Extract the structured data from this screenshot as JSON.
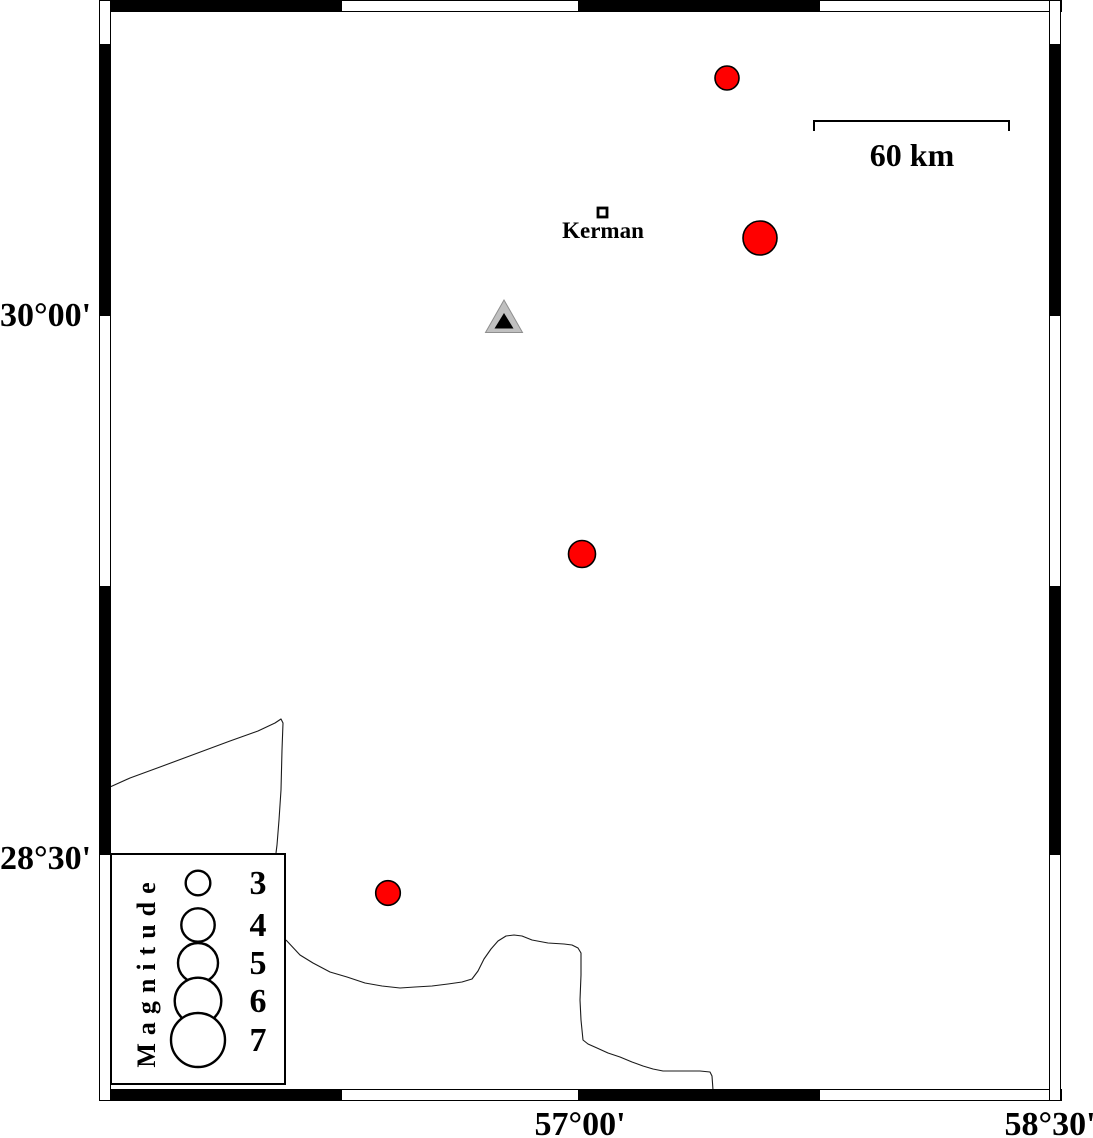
{
  "map": {
    "axis_labels": {
      "left": [
        {
          "text": "30°00'",
          "y_px": 315,
          "latitude": "30°00'"
        },
        {
          "text": "28°30'",
          "y_px": 858,
          "latitude": "28°30'"
        }
      ],
      "bottom": [
        {
          "text": "57°00'",
          "x_px": 580,
          "longitude": "57°00'"
        },
        {
          "text": "58°30'",
          "x_px": 1050,
          "longitude": "58°30'"
        }
      ]
    },
    "scale_bar": {
      "label": "60 km",
      "x1": 814,
      "x2": 1009,
      "y": 121,
      "tick_drop": 10,
      "length_km": 60
    },
    "city": {
      "name": "Kerman",
      "marker": {
        "shape": "open-square",
        "x": 598,
        "y": 208,
        "size": 9
      }
    },
    "station": {
      "symbol": "triangle",
      "outer_points": [
        [
          504,
          300
        ],
        [
          485.5,
          332.5
        ],
        [
          522.5,
          332.5
        ]
      ],
      "inner_points": [
        [
          504,
          313
        ],
        [
          494.5,
          328.5
        ],
        [
          513.5,
          328.5
        ]
      ]
    },
    "earthquakes": [
      {
        "x": 727,
        "y": 78,
        "r_px": 12.0,
        "magnitude_approx": 3.0,
        "lon_approx": 57.45,
        "lat_approx": 30.66
      },
      {
        "x": 760,
        "y": 238,
        "r_px": 17.0,
        "magnitude_approx": 4.1,
        "lon_approx": 57.56,
        "lat_approx": 30.21
      },
      {
        "x": 582,
        "y": 554,
        "r_px": 13.5,
        "magnitude_approx": 3.3,
        "lon_approx": 57.0,
        "lat_approx": 29.34
      },
      {
        "x": 388,
        "y": 893,
        "r_px": 12.3,
        "magnitude_approx": 3.0,
        "lon_approx": 56.39,
        "lat_approx": 28.4
      }
    ],
    "coastlines": [
      [
        [
          110,
          787
        ],
        [
          130,
          778
        ],
        [
          160,
          767
        ],
        [
          195,
          754
        ],
        [
          230,
          741
        ],
        [
          258,
          731
        ],
        [
          275,
          723
        ],
        [
          281,
          719
        ],
        [
          283,
          723
        ],
        [
          282,
          750
        ],
        [
          281,
          790
        ],
        [
          279,
          820
        ],
        [
          277,
          845
        ],
        [
          276,
          853
        ]
      ],
      [
        [
          286,
          940
        ],
        [
          300,
          955
        ],
        [
          313,
          963
        ],
        [
          330,
          972
        ],
        [
          347,
          977
        ],
        [
          365,
          983
        ],
        [
          382,
          986
        ],
        [
          400,
          988
        ],
        [
          415,
          987
        ],
        [
          432,
          986
        ],
        [
          448,
          984
        ],
        [
          462,
          982
        ],
        [
          472,
          979
        ],
        [
          478,
          971
        ],
        [
          484,
          959
        ],
        [
          491,
          949
        ],
        [
          498,
          941
        ],
        [
          506,
          936
        ],
        [
          514,
          935
        ],
        [
          522,
          936
        ],
        [
          532,
          940
        ],
        [
          548,
          943
        ],
        [
          564,
          944
        ],
        [
          572,
          945
        ],
        [
          578,
          948
        ],
        [
          581,
          953
        ],
        [
          581,
          975
        ],
        [
          580,
          1000
        ],
        [
          581,
          1020
        ],
        [
          583,
          1040
        ],
        [
          588,
          1044
        ],
        [
          597,
          1048
        ],
        [
          608,
          1053
        ],
        [
          620,
          1057
        ],
        [
          632,
          1062
        ],
        [
          643,
          1066
        ],
        [
          653,
          1069
        ],
        [
          663,
          1071
        ],
        [
          680,
          1071
        ],
        [
          700,
          1071
        ],
        [
          710,
          1072
        ],
        [
          712,
          1076
        ],
        [
          713,
          1090
        ]
      ]
    ]
  },
  "legend": {
    "title": "Magnitude",
    "box": {
      "x": 110,
      "y": 853,
      "width": 176,
      "height": 232
    },
    "circle_cx": 198,
    "label_cx": 257,
    "entries": [
      {
        "label": "3",
        "cy": 883,
        "r": 12.3
      },
      {
        "label": "4",
        "cy": 925,
        "r": 16.7
      },
      {
        "label": "5",
        "cy": 963,
        "r": 20.0
      },
      {
        "label": "6",
        "cy": 1001,
        "r": 23.3
      },
      {
        "label": "7",
        "cy": 1040,
        "r": 27.0
      }
    ]
  },
  "colors": {
    "earthquake_fill": "#ff0000",
    "outline": "#000000",
    "station_outer": "#c0c0c0",
    "station_inner": "#000000",
    "coastline": "#1a1a1a"
  }
}
